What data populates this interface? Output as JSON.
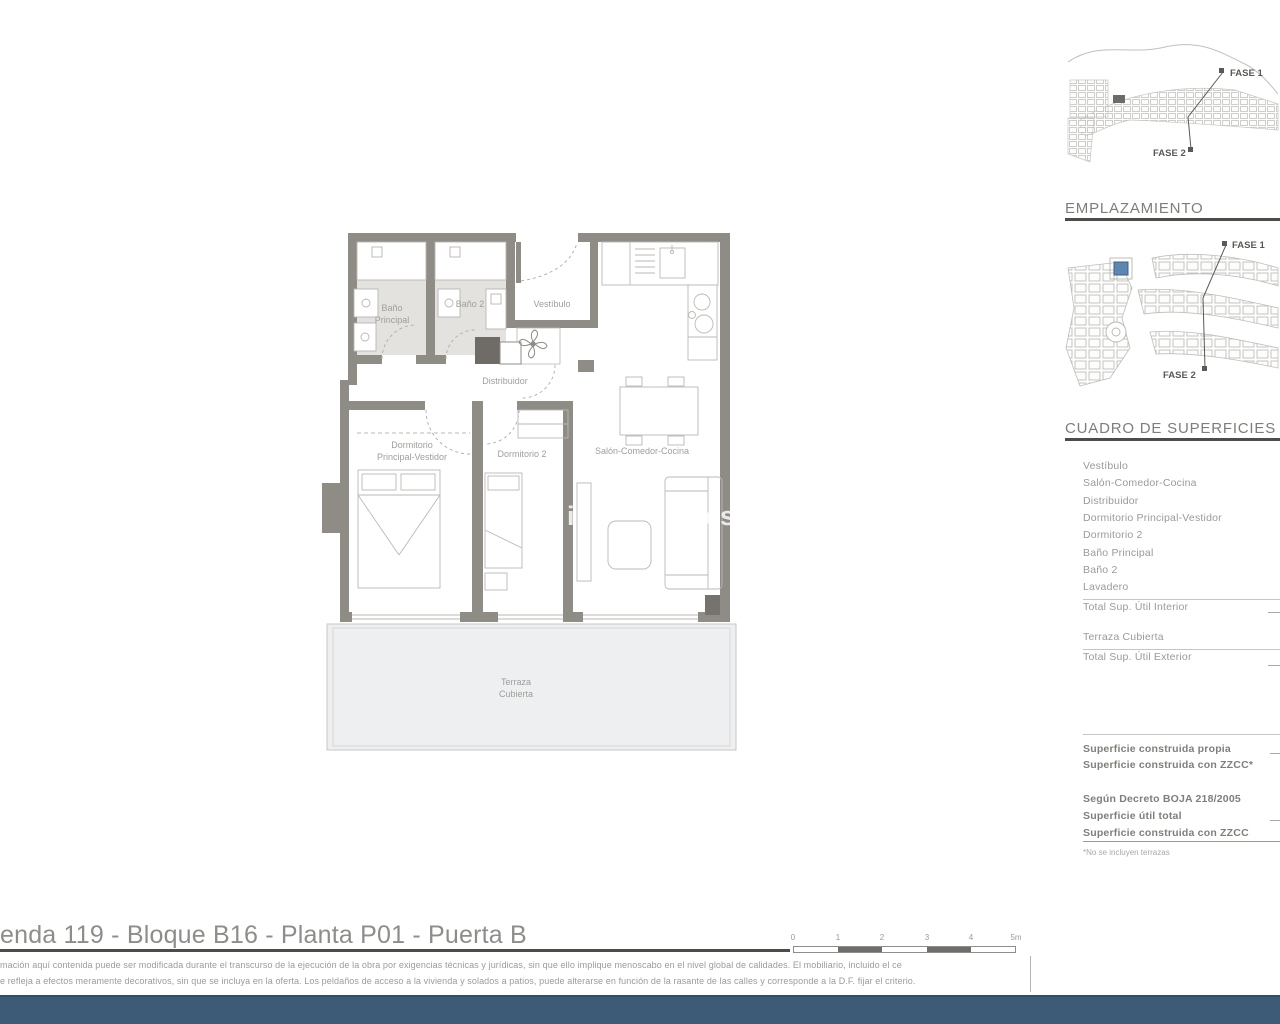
{
  "floor_plan": {
    "rooms": {
      "bano_principal_l1": "Baño",
      "bano_principal_l2": "Principal",
      "bano2": "Baño 2",
      "vestibulo": "Vestíbulo",
      "distribuidor": "Distribuidor",
      "dormitorio_principal_l1": "Dormitorio",
      "dormitorio_principal_l2": "Principal-Vestidor",
      "dormitorio2": "Dormitorio 2",
      "salon": "Salón-Comedor-Cocina",
      "terraza_l1": "Terraza",
      "terraza_l2": "Cubierta"
    },
    "watermark_fragment_1": "i",
    "watermark_fragment_2": "es",
    "wall_color": "#8f8c86"
  },
  "site_plans": {
    "overview": {
      "fase1_label": "FASE 1",
      "fase2_label": "FASE 2"
    },
    "emplazamiento": {
      "heading": "EMPLAZAMIENTO",
      "fase1_label": "FASE 1",
      "fase2_label": "FASE 2",
      "highlight_color": "#5d87b0"
    }
  },
  "surfaces": {
    "heading": "CUADRO DE SUPERFICIES",
    "rows": [
      "Vestíbulo",
      "Salón-Comedor-Cocina",
      "Distribuidor",
      "Dormitorio Principal-Vestidor",
      "Dormitorio 2",
      "Baño Principal",
      "Baño 2",
      "Lavadero"
    ],
    "total_interior_label": "Total Sup. Útil Interior",
    "terraza_label": "Terraza Cubierta",
    "total_exterior_label": "Total Sup. Útil Exterior",
    "construida_propia_label": "Superficie construida propia",
    "construida_zzcc_label": "Superficie construida con ZZCC*",
    "decreto_label": "Según Decreto BOJA 218/2005",
    "util_total_label": "Superficie útil total",
    "construida_zzcc2_label": "Superficie construida con ZZCC",
    "footnote": "*No se incluyen terrazas"
  },
  "footer": {
    "title": "enda 119 - Bloque B16 - Planta P01 - Puerta B",
    "disclaimer_line1": "mación aquí contenida puede  ser modificada durante el transcurso de la ejecución de la obra por exigencias técnicas y jurídicas,  sin  que  ello  implique  menoscabo  en el nivel global de calidades.  El  mobiliario, incluido el ce",
    "disclaimer_line2": "e refleja a efectos meramente decorativos, sin que se incluya en la oferta. Los peldaños de acceso a la vivienda y  solados  a  patios,  puede alterarse  en función de la rasante de las calles y corresponde a  la  D.F.  fijar el criterio.",
    "scale_labels": [
      "0",
      "1",
      "2",
      "3",
      "4",
      "5m"
    ],
    "bar_color": "#3d5a77"
  }
}
